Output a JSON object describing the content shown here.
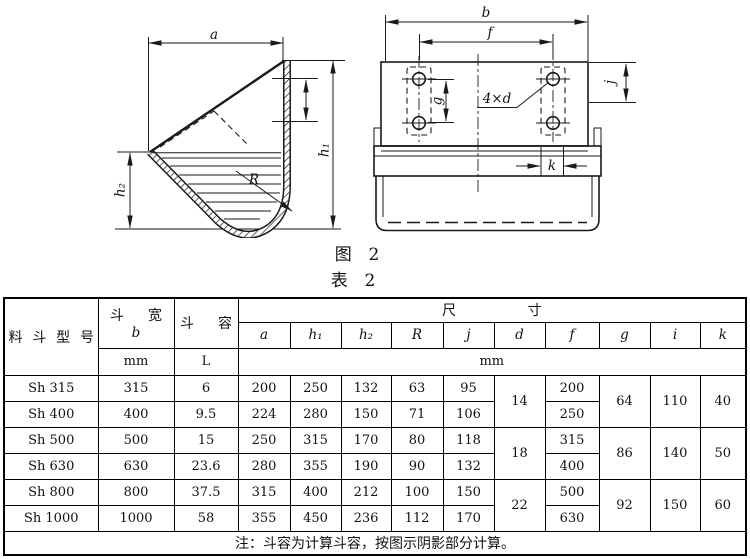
{
  "figure": {
    "caption": "图  2",
    "left": {
      "a": "a",
      "h1": "h₁",
      "h2": "h₂",
      "R": "R"
    },
    "right": {
      "b": "b",
      "f": "f",
      "g": "g",
      "j": "j",
      "k": "k",
      "holes": "4×d"
    }
  },
  "table": {
    "caption": "表  2",
    "header": {
      "model": "料斗型号",
      "width_title": "斗 宽",
      "width_sym": "b",
      "width_unit": "mm",
      "vol_title": "斗 容",
      "vol_unit": "L",
      "dims_title": "尺 寸",
      "dims_unit": "mm",
      "dim_cols": [
        "a",
        "h₁",
        "h₂",
        "R",
        "j",
        "d",
        "f",
        "g",
        "i",
        "k"
      ]
    },
    "rows": [
      {
        "model": "Sh 315",
        "b": "315",
        "vol": "6",
        "a": "200",
        "h1": "250",
        "h2": "132",
        "R": "63",
        "j": "95",
        "d": "14",
        "f": "200",
        "g": "64",
        "i": "110",
        "k": "40"
      },
      {
        "model": "Sh 400",
        "b": "400",
        "vol": "9.5",
        "a": "224",
        "h1": "280",
        "h2": "150",
        "R": "71",
        "j": "106",
        "f": "250"
      },
      {
        "model": "Sh 500",
        "b": "500",
        "vol": "15",
        "a": "250",
        "h1": "315",
        "h2": "170",
        "R": "80",
        "j": "118",
        "d": "18",
        "f": "315",
        "g": "86",
        "i": "140",
        "k": "50"
      },
      {
        "model": "Sh 630",
        "b": "630",
        "vol": "23.6",
        "a": "280",
        "h1": "355",
        "h2": "190",
        "R": "90",
        "j": "132",
        "f": "400"
      },
      {
        "model": "Sh 800",
        "b": "800",
        "vol": "37.5",
        "a": "315",
        "h1": "400",
        "h2": "212",
        "R": "100",
        "j": "150",
        "d": "22",
        "f": "500",
        "g": "92",
        "i": "150",
        "k": "60"
      },
      {
        "model": "Sh 1000",
        "b": "1000",
        "vol": "58",
        "a": "355",
        "h1": "450",
        "h2": "236",
        "R": "112",
        "j": "170",
        "f": "630"
      }
    ],
    "note": "注：斗容为计算斗容，按图示阴影部分计算。"
  }
}
